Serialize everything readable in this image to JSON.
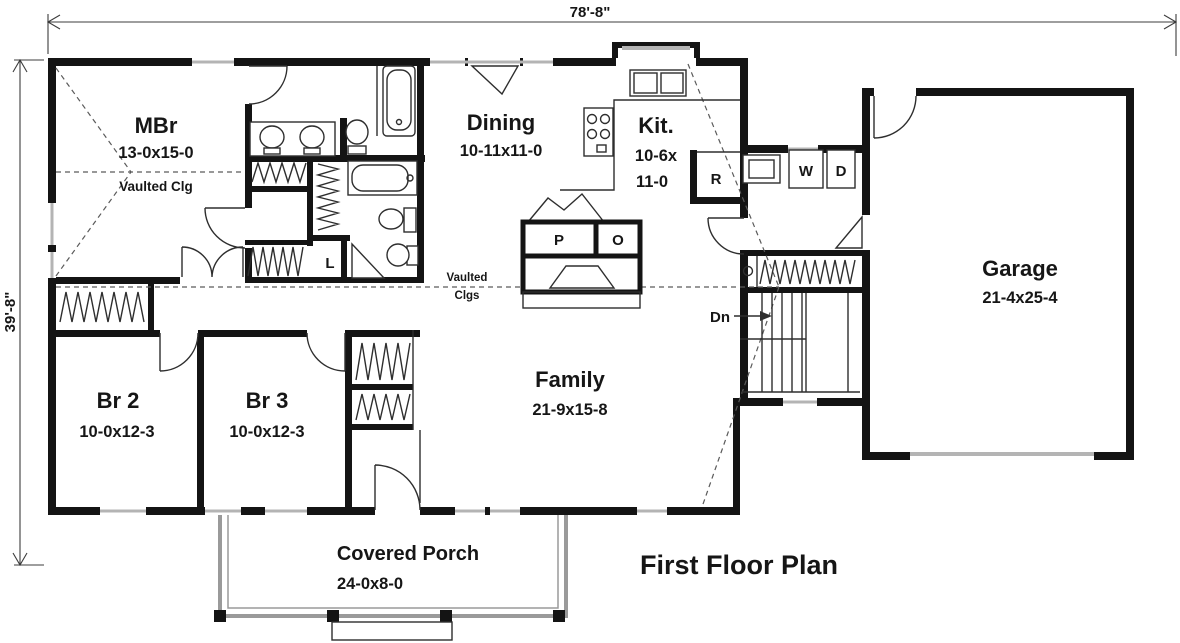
{
  "title": {
    "label": "First Floor Plan"
  },
  "dimensions": {
    "width": "78'-8\"",
    "depth": "39'-8\""
  },
  "rooms": {
    "master_bedroom": {
      "name": "MBr",
      "size": "13-0x15-0",
      "note": "Vaulted Clg"
    },
    "dining": {
      "name": "Dining",
      "size": "10-11x11-0"
    },
    "kitchen": {
      "name": "Kit.",
      "size_line1": "10-6x",
      "size_line2": "11-0"
    },
    "garage": {
      "name": "Garage",
      "size": "21-4x25-4"
    },
    "bedroom2": {
      "name": "Br 2",
      "size": "10-0x12-3"
    },
    "bedroom3": {
      "name": "Br 3",
      "size": "10-0x12-3"
    },
    "family": {
      "name": "Family",
      "size": "21-9x15-8"
    },
    "covered_porch": {
      "name": "Covered Porch",
      "size": "24-0x8-0"
    }
  },
  "annotations": {
    "vaulted_ceilings_line1": "Vaulted",
    "vaulted_ceilings_line2": "Clgs",
    "stairs_down": "Dn"
  },
  "fixtures": {
    "refrigerator": "R",
    "washer": "W",
    "dryer": "D",
    "pantry": "P",
    "oven": "O",
    "linen": "L"
  },
  "colors": {
    "walls": "#141414",
    "thin_lines": "#2e2e2e",
    "window_fill": "#b4b4b4",
    "porch_lines": "#9a9a9a",
    "background": "#ffffff"
  }
}
